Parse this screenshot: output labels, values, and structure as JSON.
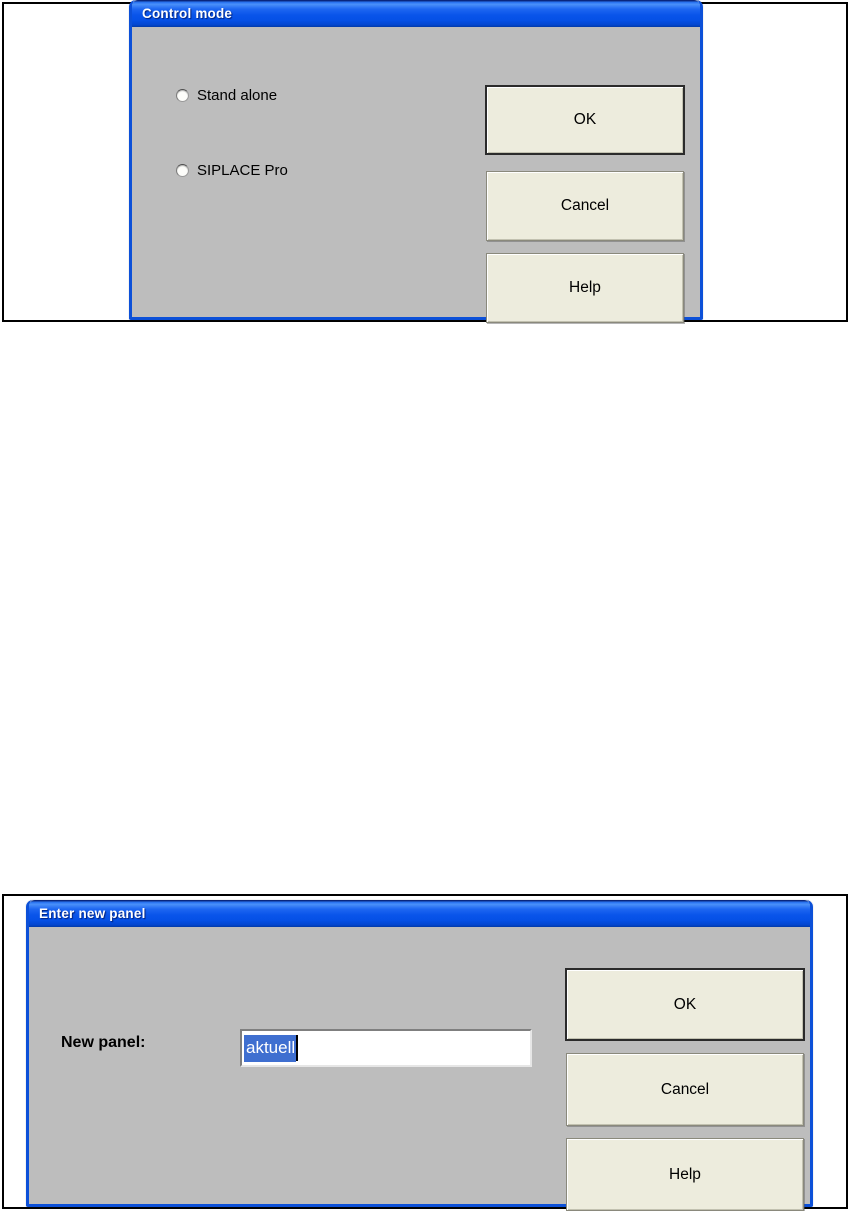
{
  "colors": {
    "titlebar_blue": "#0a55ea",
    "dialog_frame_blue": "#0c50d8",
    "dialog_body_gray": "#bdbdbd",
    "button_face_cream": "#edecdd",
    "selection_blue": "#3f6fd0",
    "outer_frame_border": "#000000",
    "page_background": "#ffffff"
  },
  "control_mode_dialog": {
    "title": "Control mode",
    "radio_options": [
      {
        "label": "Stand alone",
        "checked": false
      },
      {
        "label": "SIPLACE Pro",
        "checked": false
      }
    ],
    "buttons": {
      "ok": "OK",
      "cancel": "Cancel",
      "help": "Help"
    }
  },
  "enter_new_panel_dialog": {
    "title": "Enter new panel",
    "field_label": "New panel:",
    "field_value": "aktuell",
    "field_value_selected": true,
    "buttons": {
      "ok": "OK",
      "cancel": "Cancel",
      "help": "Help"
    }
  }
}
